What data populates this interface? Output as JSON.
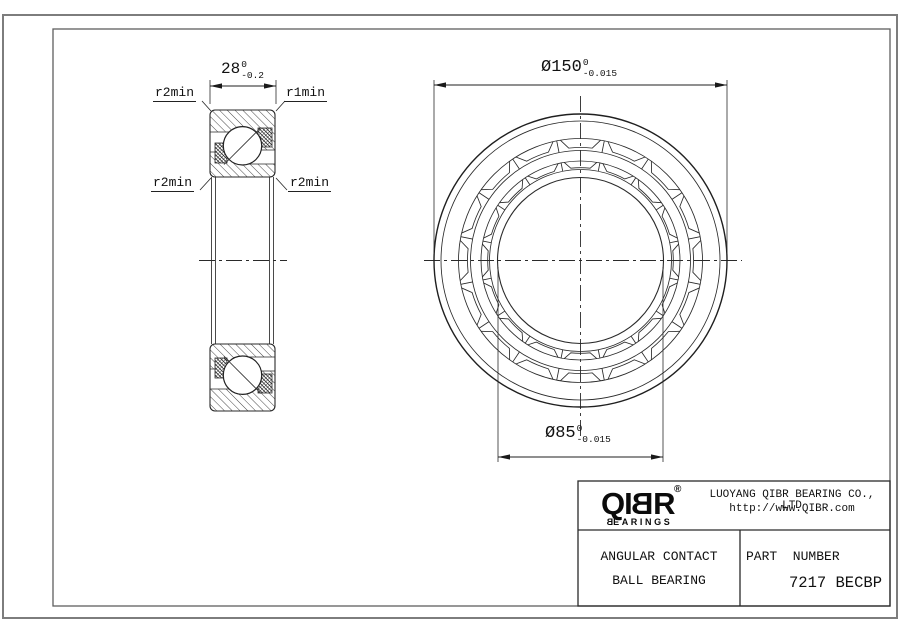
{
  "colors": {
    "line": "#2a2a2a",
    "frame": "#6e6e6e",
    "text": "#111111",
    "logo": "#0b0b0b"
  },
  "drawing": {
    "left_view": {
      "dim_width": {
        "value": "28",
        "tol_top": "0",
        "tol_bottom": "-0.2"
      },
      "labels": {
        "top_left": "r2min",
        "top_right": "r1min",
        "bottom_left": "r2min",
        "bottom_right": "r2min"
      }
    },
    "front_view": {
      "dim_outer_diameter": {
        "value": "Ø150",
        "tol_top": "0",
        "tol_bottom": "-0.015"
      },
      "dim_bore_diameter": {
        "value": "Ø85",
        "tol_top": "0",
        "tol_bottom": "-0.015"
      }
    }
  },
  "title_block": {
    "logo": {
      "q": "Q",
      "i": "I",
      "b": "B",
      "r": "R",
      "registered": "®",
      "sub_first": "B",
      "sub_rest": "EARINGS"
    },
    "company_line1": "LUOYANG QIBR BEARING CO., LTD",
    "company_line2": "http://www.QIBR.com",
    "product_line1": "ANGULAR CONTACT",
    "product_line2": "BALL BEARING",
    "part_number_label": "PART  NUMBER",
    "part_number_value": "7217 BECBP"
  }
}
